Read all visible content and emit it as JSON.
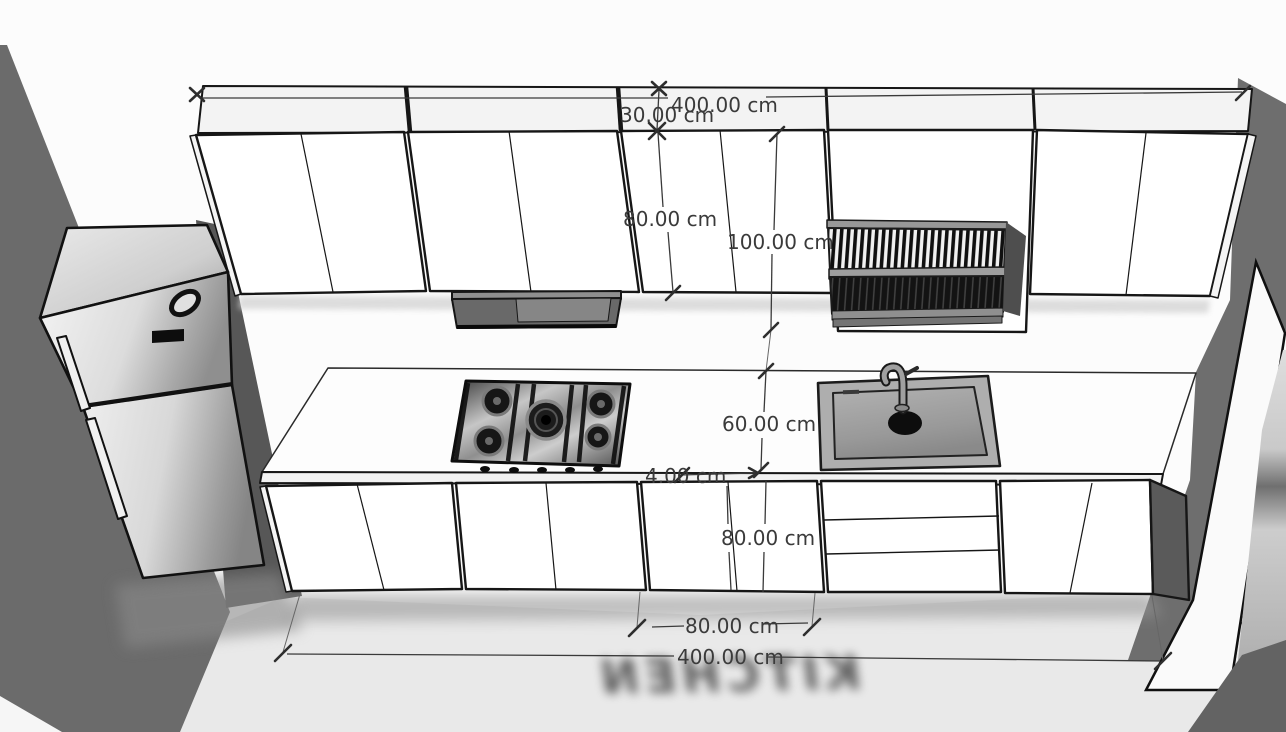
{
  "scene": {
    "kind": "3D kitchen elevation viewport",
    "floor_label": "KITCHEN"
  },
  "dimensions": {
    "upper_total_width": "400.00 cm",
    "upper_cabinet_depth": "30.00 cm",
    "upper_cabinet_height": "80.00 cm",
    "open_cabinet_height": "100.00 cm",
    "countertop_depth": "60.00 cm",
    "countertop_thickness": "4.00 cm",
    "base_cabinet_height": "80.00 cm",
    "base_unit_width": "80.00 cm",
    "base_total_width": "400.00 cm"
  },
  "colors": {
    "wall_background": "#fcfcfc",
    "floor": "#e9e9e9",
    "shadow_wall_left": "#6b6b6b",
    "shadow_wall_right": "#6e6e6e",
    "cabinet_face": "#ffffff",
    "outline": "#161616",
    "dimension_text": "#3a3a3a",
    "stainless_light": "#f0f0f0",
    "stainless_dark": "#8f8f8f"
  }
}
